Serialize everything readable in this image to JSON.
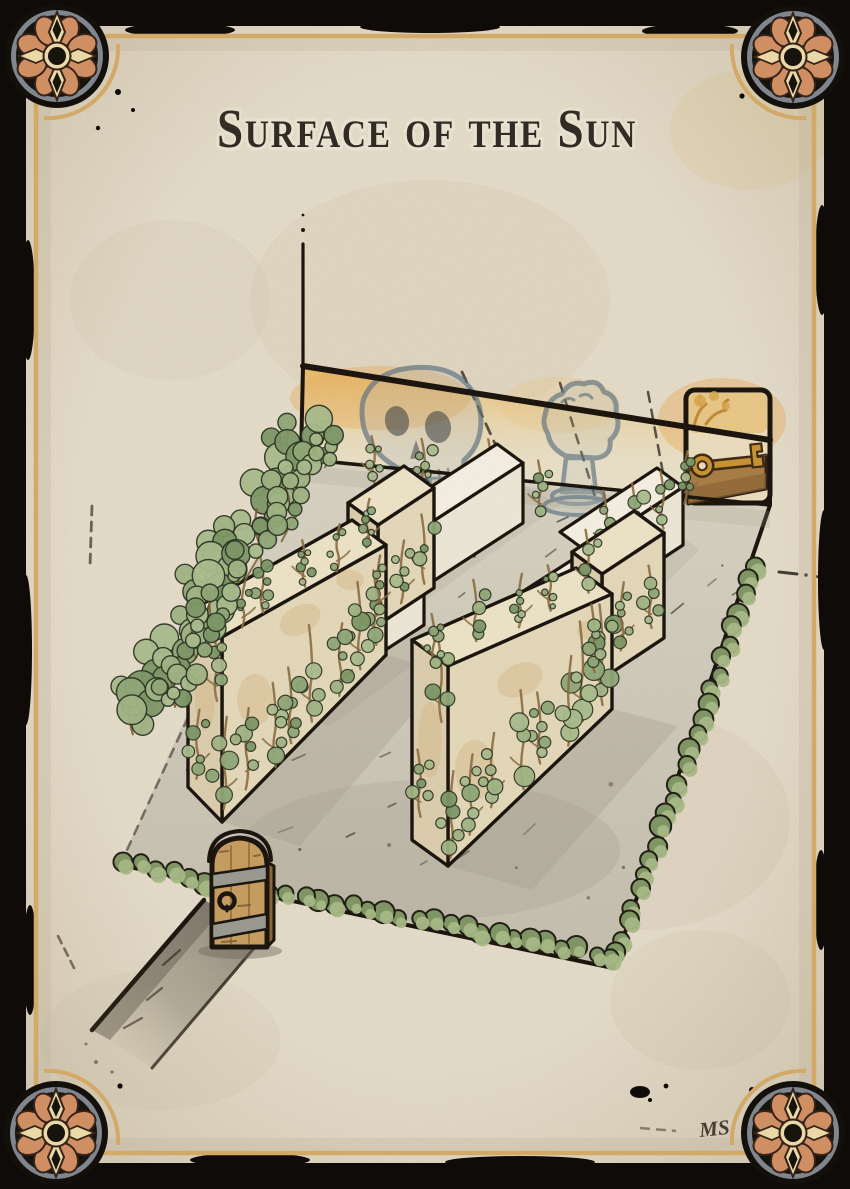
{
  "card": {
    "title": "Surface of the Sun",
    "signature": "MS"
  },
  "scene": {
    "kind": "isometric-walled-garden-map",
    "mural_icons": [
      "skull-icon",
      "hand-icon",
      "key-icon"
    ],
    "corner_ornament_icon": "rosette-icon",
    "corner_ornament_count": 4
  },
  "colors": {
    "frame_black": "#0e0b08",
    "parchment": "#e6ddcb",
    "gold_border": "#d3a968",
    "title_ink": "#2b2620",
    "outline_ink": "#150f09",
    "rosette_orange": "#d08f63",
    "rosette_cream": "#ead9a6",
    "rosette_ring_gray": "#7f868e",
    "mural_blue_gray": "#6e8596",
    "amber_wall_wash": "#eec178",
    "key_gold": "#c8922f",
    "shelf_brown": "#a87c42",
    "stone_cream": "#e9dfc4",
    "white_wall": "#f5f0e2",
    "vine_green": "#8fa877",
    "hedge_green": "#a3b784",
    "door_brown": "#c79d5e",
    "floor_gray": "#d0cbbb",
    "shadow_gray": "#a59e8e"
  }
}
